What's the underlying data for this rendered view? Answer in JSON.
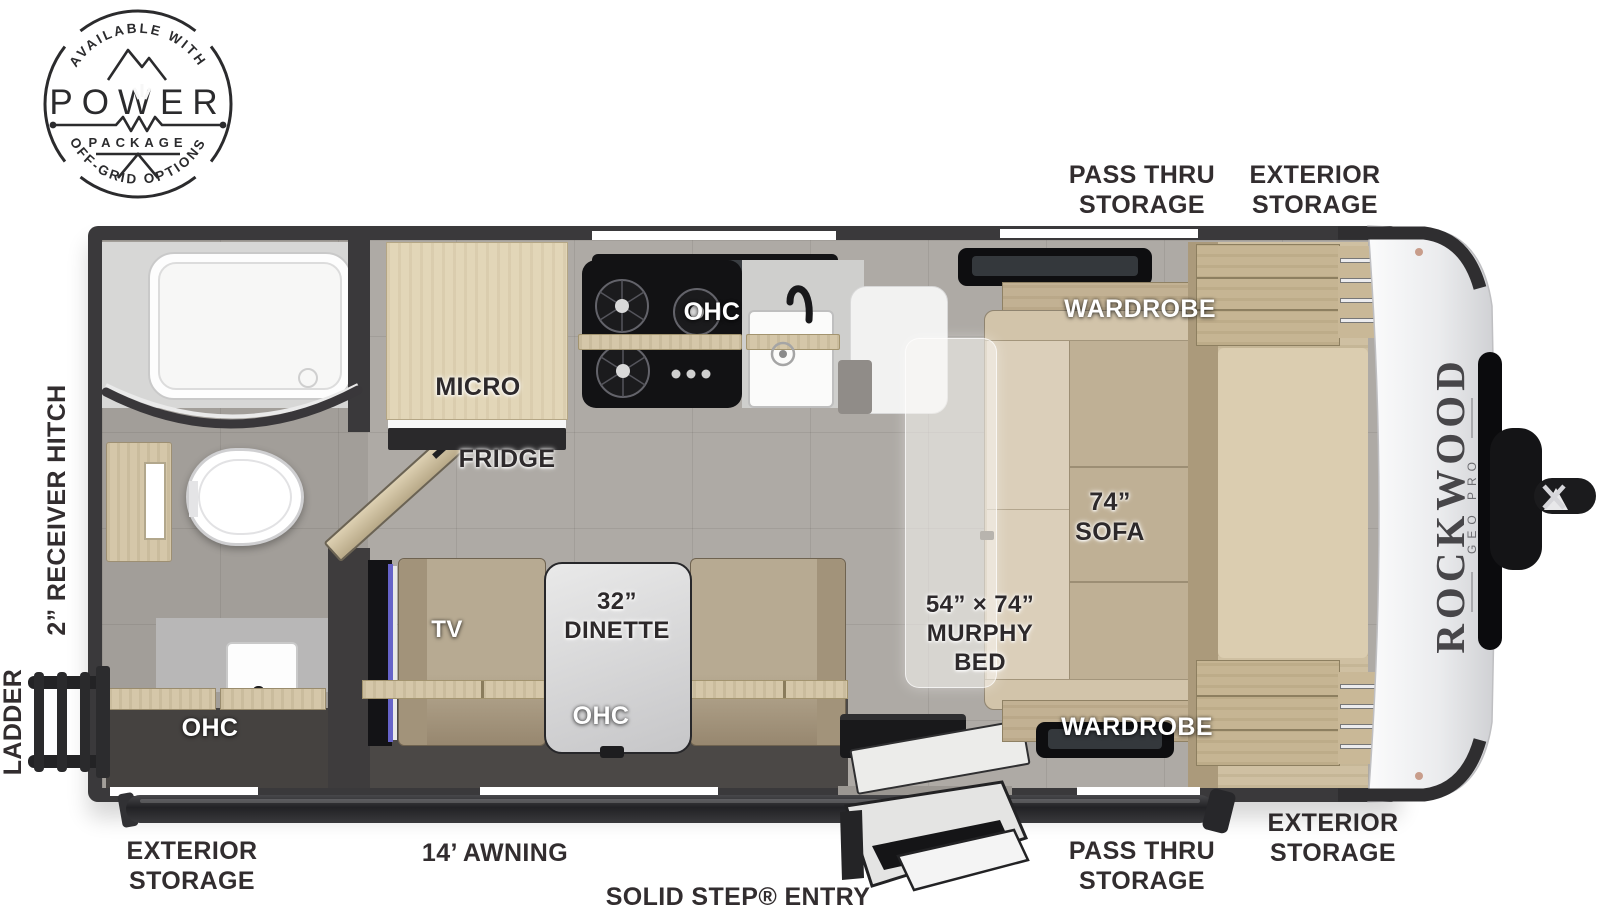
{
  "badge": {
    "arc_top": "AVAILABLE WITH",
    "title": "POWER",
    "subtitle": "PACKAGE",
    "arc_bottom": "OFF-GRID OPTIONS"
  },
  "brand": {
    "name": "ROCKWOOD",
    "model": "GEO PRO"
  },
  "exterior_labels": {
    "pass_thru_top": "PASS THRU\nSTORAGE",
    "exterior_top": "EXTERIOR\nSTORAGE",
    "receiver_hitch": "2” RECEIVER HITCH",
    "ladder": "LADDER",
    "exterior_bottom_left": "EXTERIOR\nSTORAGE",
    "awning": "14’ AWNING",
    "solid_step": "SOLID STEP® ENTRY",
    "pass_thru_bottom": "PASS THRU\nSTORAGE",
    "exterior_bottom_right": "EXTERIOR\nSTORAGE"
  },
  "interior_labels": {
    "micro": "MICRO",
    "fridge": "FRIDGE",
    "kitchen_ohc": "OHC",
    "bath_ohc": "OHC",
    "tv": "TV",
    "dinette": "32”\nDINETTE",
    "dinette_ohc": "OHC",
    "murphy_bed": "54” × 74”\nMURPHY\nBED",
    "sofa": "74”\nSOFA",
    "wardrobe_top": "WARDROBE",
    "wardrobe_bottom": "WARDROBE"
  },
  "colors": {
    "wall": "#3a393b",
    "floor": "#aeaaa5",
    "wood_light": "#e2d6b8",
    "wood": "#cfc0a2",
    "sofa": "#c7b89d",
    "label_dark": "#2d292b",
    "label_white": "#ffffff",
    "cap_white": "#f2f2f4"
  }
}
